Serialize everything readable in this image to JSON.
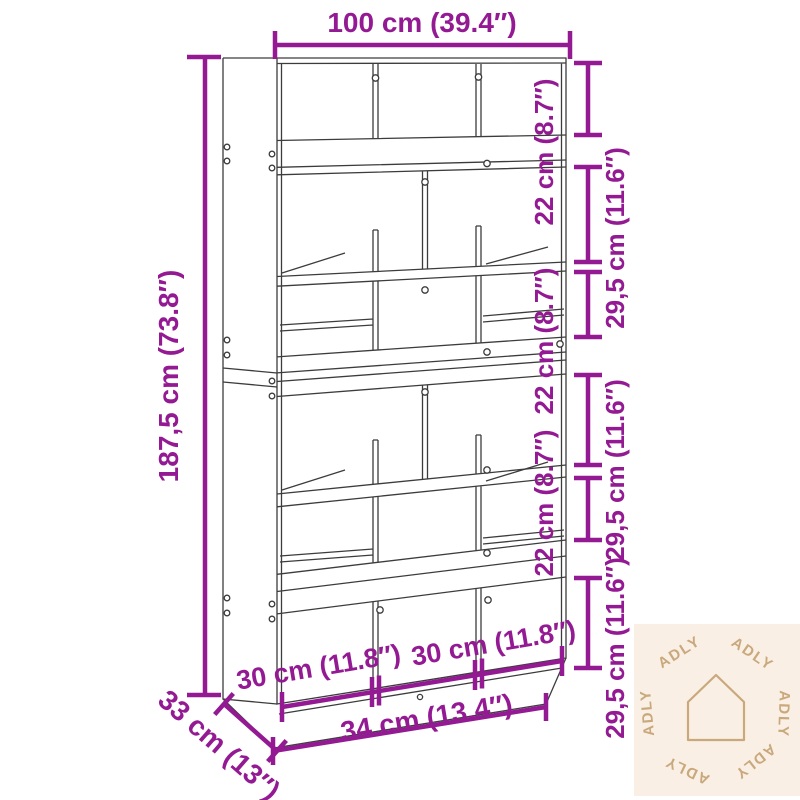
{
  "diagram": {
    "type": "furniture-dimension-diagram",
    "product": "bookcase-room-divider",
    "colors": {
      "dimension_accent": "#941a94",
      "drawing_line": "#3c3c3c",
      "watermark_bg": "#f9efe4",
      "watermark_fg": "#c9a87c"
    },
    "labels": {
      "top_width": "100 cm (39.4″)",
      "left_height": "187,5 cm (73.8″)",
      "right_inner": [
        "22 cm (8.7″)",
        "22 cm (8.7″)",
        "22 cm (8.7″)"
      ],
      "right_outer": [
        "29,5 cm (11.6″)",
        "29,5 cm (11.6″)",
        "29,5 cm (11.6″)"
      ],
      "bottom_compartments": [
        "30 cm (11.8″)",
        "30 cm (11.8″)"
      ],
      "bottom_base": "34 cm (13.4″)",
      "depth": "33 cm (13″)"
    },
    "watermark": {
      "brand": "ADLY",
      "icon": "house-outline-icon",
      "repetitions": 6
    }
  }
}
